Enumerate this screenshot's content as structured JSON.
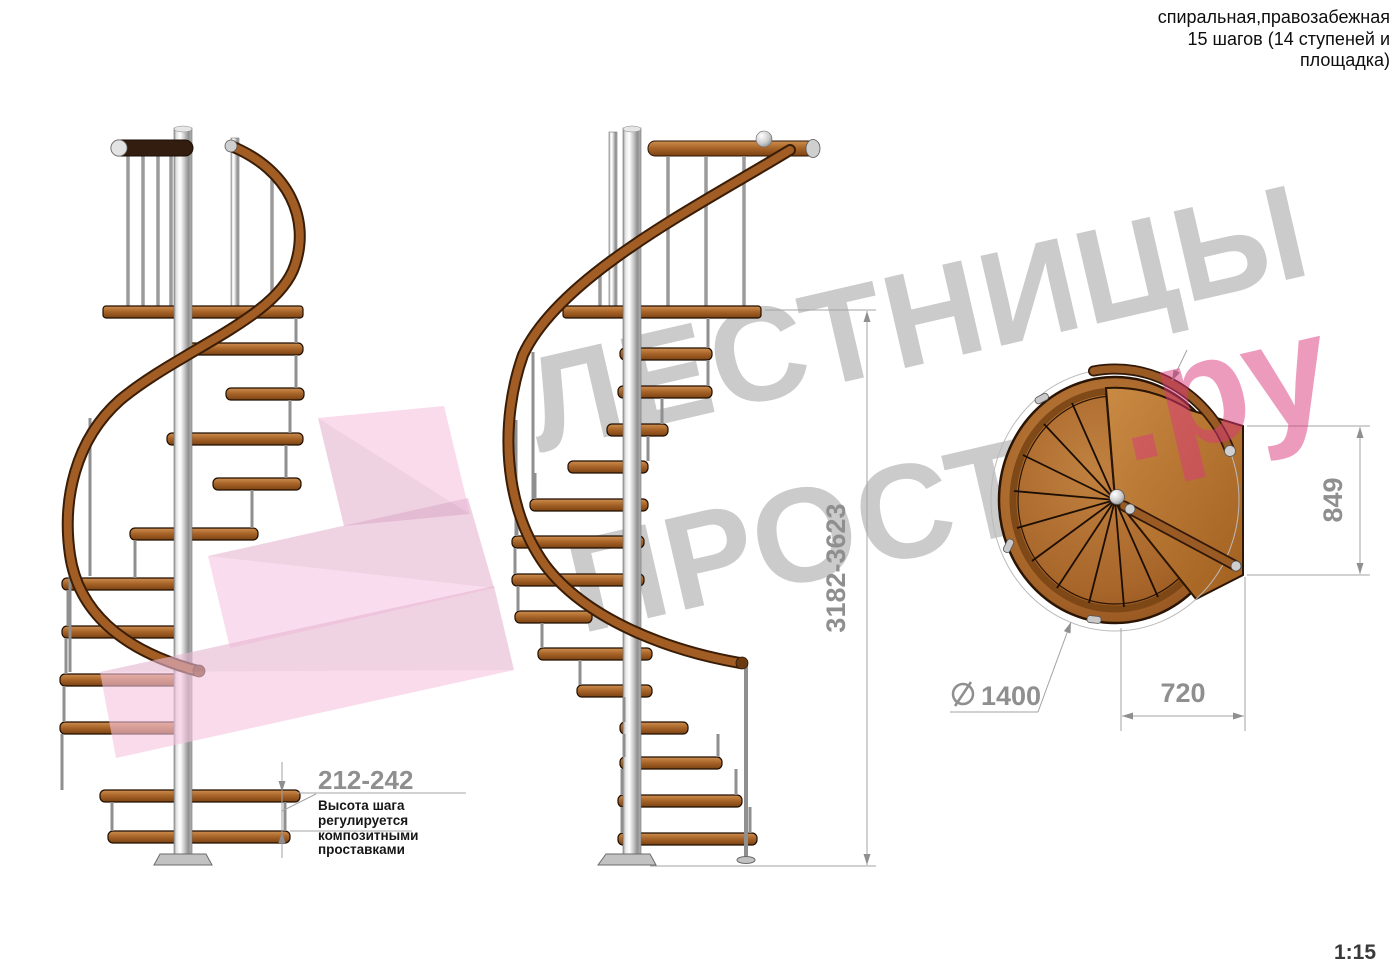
{
  "header": {
    "lines": [
      "спиральная,правозабежная",
      "15 шагов (14 ступеней и",
      "площадка)"
    ]
  },
  "watermark": {
    "brand_line1": "ЛЕСТНИЦЫ",
    "brand_line2": "ПРОСТО",
    "brand_suffix": ".ру"
  },
  "drawing": {
    "dimensions": {
      "total_height": "3182-3623",
      "step_height": "212-242",
      "step_height_note": {
        "lines": [
          "Высота шага",
          "регулируется",
          "композитными",
          "проставками"
        ]
      },
      "platform_depth": "849",
      "platform_width": "720",
      "diameter_value": "1400"
    },
    "scale": "1:15"
  },
  "colors": {
    "wood_light": "#cf9050",
    "wood_dark": "#7c4212",
    "chrome": "#d9d9d9",
    "dimension_gray": "#8f8f8f",
    "watermark_gray": "#cbcbcb",
    "watermark_pink": "#db387c",
    "logo_pink": "#f5c3e0"
  }
}
